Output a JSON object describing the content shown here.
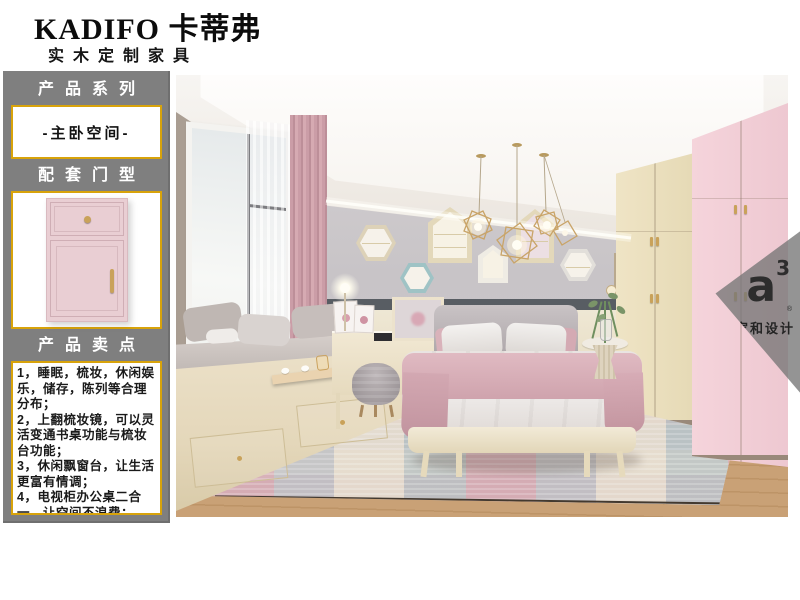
{
  "header": {
    "brand": "KADIFO 卡蒂弗",
    "tagline": "实木定制家具"
  },
  "sidebar": {
    "series_title": "产品系列",
    "series_value": "-主卧空间-",
    "door_title": "配套门型",
    "selling_title": "产品卖点",
    "selling_points": [
      "1，睡眠，梳妆，休闲娱乐，储存，陈列等合理分布；",
      "2，上翻梳妆镜，可以灵活变通书桌功能与梳妆台功能；",
      "3，休闲飘窗台，让生活更富有情调；",
      "4，电视柜办公桌二合一，让空间不浪费；"
    ]
  },
  "watermark": {
    "logo": "a",
    "logo_sup": "3",
    "reg": "®",
    "label": "家和设计"
  },
  "colors": {
    "accent_gold": "#d8a30a",
    "panel_gray": "#7f7f7f",
    "door_pink": "#e9ced3"
  }
}
